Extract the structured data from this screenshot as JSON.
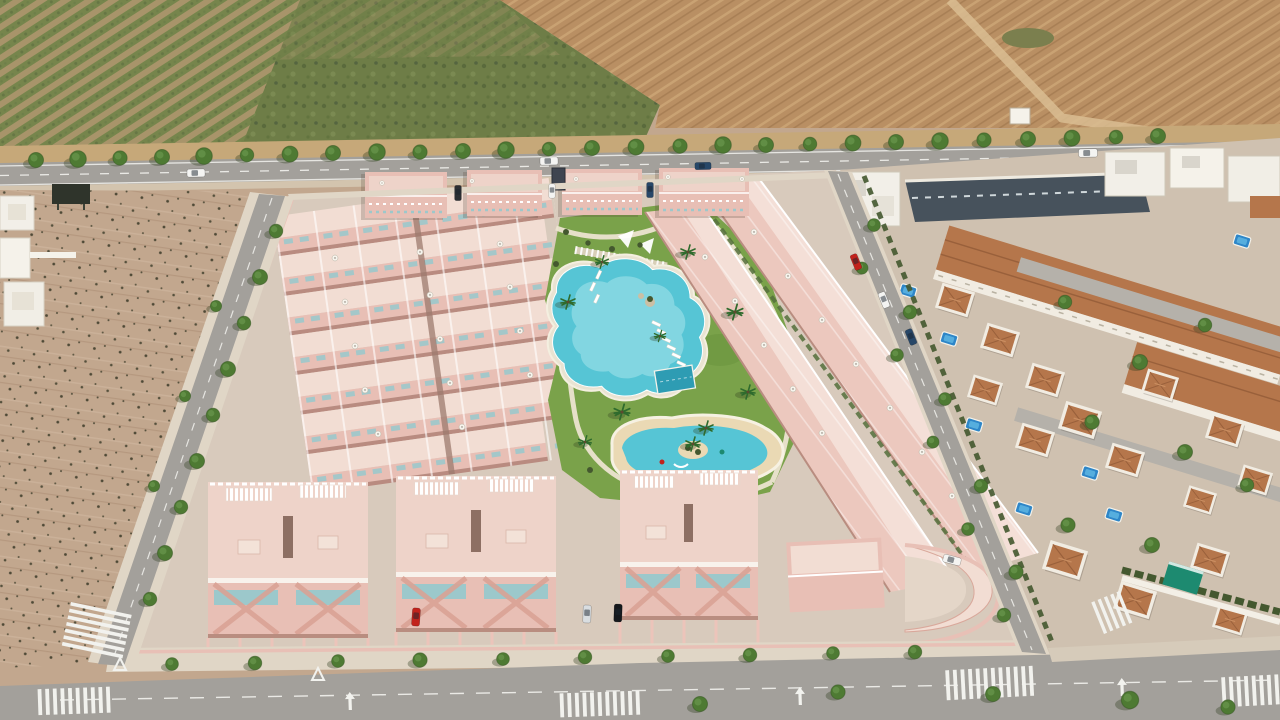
{
  "scene": {
    "kind": "aerial-3d-architectural-render",
    "setting": "new-build pink residential complex with communal pool gardens, bordered by an avenue, an empty plot, orchard and ploughed farmland, next to an existing Mediterranean villa neighbourhood"
  },
  "palette": {
    "orchard_soil": "#a8946a",
    "orchard_rows": "#76854c",
    "scrub_green": "#6e7d47",
    "field_tan": "#b98f63",
    "field_path": "#d9bd92",
    "verge_tan": "#c6a879",
    "road_asphalt": "#a3a09b",
    "marking_white": "#f2f2ee",
    "dirt_lot": "#c2a78e",
    "pavement": "#d8cabc",
    "sidewalk": "#e0d6c6",
    "pink_wall": "#e8bfb5",
    "pink_light": "#f4dfd7",
    "pink_roof": "#eed3c9",
    "pink_shadow": "#b98d80",
    "teal_glass": "#9cc8cb",
    "lawn": "#7aa24a",
    "lawn_dark": "#6a9440",
    "pool_water": "#56c5d5",
    "pool_shallow": "#aee8ee",
    "pool_dark": "#2e9cb3",
    "sand": "#ead9b4",
    "terracotta": "#b5764b",
    "terracotta_dark": "#99603b",
    "old_wall": "#f1ece2",
    "old_base": "#cfc1b0",
    "old_street": "#b5b1aa",
    "dark_row": "#47525c",
    "hedge": "#44582f",
    "awning_teal": "#1d8a70",
    "billboard_dark": "#2f342b",
    "car_red": "#c2221c",
    "car_silver": "#d9dde0",
    "car_black": "#15181c",
    "car_navy": "#274768",
    "van_white": "#f4f4f2"
  },
  "objects": {
    "road_trees": [
      {
        "x": 36,
        "y": 160,
        "s": 1
      },
      {
        "x": 78,
        "y": 159,
        "s": 1.1
      },
      {
        "x": 120,
        "y": 158,
        "s": 0.95
      },
      {
        "x": 162,
        "y": 157,
        "s": 1
      },
      {
        "x": 204,
        "y": 156,
        "s": 1.1
      },
      {
        "x": 247,
        "y": 155,
        "s": 0.9
      },
      {
        "x": 290,
        "y": 154,
        "s": 1.05
      },
      {
        "x": 333,
        "y": 153,
        "s": 1
      },
      {
        "x": 377,
        "y": 152,
        "s": 1.1
      },
      {
        "x": 420,
        "y": 152,
        "s": 0.95
      },
      {
        "x": 463,
        "y": 151,
        "s": 1
      },
      {
        "x": 506,
        "y": 150,
        "s": 1.1
      },
      {
        "x": 549,
        "y": 149,
        "s": 0.9
      },
      {
        "x": 592,
        "y": 148,
        "s": 1
      },
      {
        "x": 636,
        "y": 147,
        "s": 1.05
      },
      {
        "x": 680,
        "y": 146,
        "s": 0.95
      },
      {
        "x": 723,
        "y": 145,
        "s": 1.1
      },
      {
        "x": 766,
        "y": 145,
        "s": 1
      },
      {
        "x": 810,
        "y": 144,
        "s": 0.9
      },
      {
        "x": 853,
        "y": 143,
        "s": 1.05
      },
      {
        "x": 896,
        "y": 142,
        "s": 1
      },
      {
        "x": 940,
        "y": 141,
        "s": 1.1
      },
      {
        "x": 984,
        "y": 140,
        "s": 0.95
      },
      {
        "x": 1028,
        "y": 139,
        "s": 1
      },
      {
        "x": 1072,
        "y": 138,
        "s": 1.05
      },
      {
        "x": 1116,
        "y": 137,
        "s": 0.9
      },
      {
        "x": 1158,
        "y": 136,
        "s": 1
      }
    ],
    "left_street_trees": [
      {
        "x": 276,
        "y": 231,
        "s": 0.9
      },
      {
        "x": 260,
        "y": 277,
        "s": 1
      },
      {
        "x": 244,
        "y": 323,
        "s": 0.9
      },
      {
        "x": 228,
        "y": 369,
        "s": 1
      },
      {
        "x": 213,
        "y": 415,
        "s": 0.9
      },
      {
        "x": 197,
        "y": 461,
        "s": 1
      },
      {
        "x": 181,
        "y": 507,
        "s": 0.9
      },
      {
        "x": 165,
        "y": 553,
        "s": 1
      },
      {
        "x": 150,
        "y": 599,
        "s": 0.9
      },
      {
        "x": 216,
        "y": 306,
        "s": 0.75
      },
      {
        "x": 185,
        "y": 396,
        "s": 0.75
      },
      {
        "x": 154,
        "y": 486,
        "s": 0.75
      }
    ],
    "right_street_trees": [
      {
        "x": 874,
        "y": 225,
        "s": 0.85
      },
      {
        "x": 910,
        "y": 312,
        "s": 0.9
      },
      {
        "x": 945,
        "y": 399,
        "s": 0.85
      },
      {
        "x": 981,
        "y": 486,
        "s": 0.9
      },
      {
        "x": 1016,
        "y": 572,
        "s": 0.95
      },
      {
        "x": 862,
        "y": 268,
        "s": 0.8
      },
      {
        "x": 897,
        "y": 355,
        "s": 0.85
      },
      {
        "x": 933,
        "y": 442,
        "s": 0.8
      },
      {
        "x": 968,
        "y": 529,
        "s": 0.85
      },
      {
        "x": 1004,
        "y": 615,
        "s": 0.9
      }
    ],
    "bottom_sidewalk_trees": [
      {
        "x": 172,
        "y": 664,
        "s": 0.85
      },
      {
        "x": 255,
        "y": 663,
        "s": 0.9
      },
      {
        "x": 338,
        "y": 661,
        "s": 0.85
      },
      {
        "x": 420,
        "y": 660,
        "s": 0.95
      },
      {
        "x": 503,
        "y": 659,
        "s": 0.85
      },
      {
        "x": 585,
        "y": 657,
        "s": 0.9
      },
      {
        "x": 668,
        "y": 656,
        "s": 0.85
      },
      {
        "x": 750,
        "y": 655,
        "s": 0.9
      },
      {
        "x": 833,
        "y": 653,
        "s": 0.85
      },
      {
        "x": 915,
        "y": 652,
        "s": 0.9
      }
    ],
    "avenue_trees": [
      {
        "x": 700,
        "y": 704,
        "s": 1
      },
      {
        "x": 838,
        "y": 692,
        "s": 0.95
      },
      {
        "x": 993,
        "y": 694,
        "s": 1
      },
      {
        "x": 1130,
        "y": 700,
        "s": 1.15
      },
      {
        "x": 1228,
        "y": 707,
        "s": 0.95
      }
    ],
    "old_town_trees": [
      {
        "x": 1065,
        "y": 302,
        "s": 0.9
      },
      {
        "x": 1140,
        "y": 362,
        "s": 1
      },
      {
        "x": 1205,
        "y": 325,
        "s": 0.9
      },
      {
        "x": 1092,
        "y": 422,
        "s": 0.95
      },
      {
        "x": 1185,
        "y": 452,
        "s": 1
      },
      {
        "x": 1247,
        "y": 485,
        "s": 0.9
      },
      {
        "x": 1068,
        "y": 525,
        "s": 0.95
      },
      {
        "x": 1152,
        "y": 545,
        "s": 1
      }
    ],
    "park_palms": [
      {
        "x": 568,
        "y": 302,
        "s": 1
      },
      {
        "x": 602,
        "y": 262,
        "s": 0.9
      },
      {
        "x": 688,
        "y": 252,
        "s": 1
      },
      {
        "x": 735,
        "y": 312,
        "s": 1.1
      },
      {
        "x": 748,
        "y": 392,
        "s": 1
      },
      {
        "x": 622,
        "y": 412,
        "s": 1.1
      },
      {
        "x": 585,
        "y": 442,
        "s": 0.9
      },
      {
        "x": 706,
        "y": 428,
        "s": 1
      },
      {
        "x": 660,
        "y": 336,
        "s": 0.8
      }
    ],
    "park_bushes": [
      {
        "x": 566,
        "y": 232,
        "s": 1
      },
      {
        "x": 588,
        "y": 243,
        "s": 0.9
      },
      {
        "x": 612,
        "y": 249,
        "s": 1
      },
      {
        "x": 640,
        "y": 245,
        "s": 0.9
      },
      {
        "x": 666,
        "y": 237,
        "s": 1
      },
      {
        "x": 688,
        "y": 226,
        "s": 0.9
      },
      {
        "x": 556,
        "y": 264,
        "s": 1
      },
      {
        "x": 700,
        "y": 262,
        "s": 0.9
      },
      {
        "x": 722,
        "y": 284,
        "s": 1
      },
      {
        "x": 738,
        "y": 304,
        "s": 0.9
      },
      {
        "x": 748,
        "y": 330,
        "s": 1
      },
      {
        "x": 590,
        "y": 470,
        "s": 1
      }
    ],
    "private_pools": [
      {
        "x": 908,
        "y": 291,
        "r": 17
      },
      {
        "x": 949,
        "y": 339,
        "r": 17
      },
      {
        "x": 917,
        "y": 373,
        "r": 17
      },
      {
        "x": 974,
        "y": 425,
        "r": 17
      },
      {
        "x": 1090,
        "y": 473,
        "r": 17
      },
      {
        "x": 1114,
        "y": 515,
        "r": 17
      },
      {
        "x": 1024,
        "y": 509,
        "r": 17
      },
      {
        "x": 1242,
        "y": 241,
        "r": 17
      }
    ],
    "villas": [
      {
        "x": 955,
        "y": 300,
        "r": 17,
        "s": 1
      },
      {
        "x": 1000,
        "y": 340,
        "r": 17,
        "s": 1
      },
      {
        "x": 1045,
        "y": 380,
        "r": 17,
        "s": 1
      },
      {
        "x": 985,
        "y": 390,
        "r": 17,
        "s": 0.9
      },
      {
        "x": 1035,
        "y": 440,
        "r": 17,
        "s": 1
      },
      {
        "x": 1080,
        "y": 420,
        "r": 17,
        "s": 1.1
      },
      {
        "x": 1125,
        "y": 460,
        "r": 17,
        "s": 1
      },
      {
        "x": 1065,
        "y": 560,
        "r": 17,
        "s": 1.15
      },
      {
        "x": 1135,
        "y": 600,
        "r": 17,
        "s": 1.1
      },
      {
        "x": 1210,
        "y": 560,
        "r": 17,
        "s": 1
      },
      {
        "x": 1230,
        "y": 620,
        "r": 17,
        "s": 0.9
      },
      {
        "x": 1160,
        "y": 385,
        "r": 17,
        "s": 0.95
      },
      {
        "x": 1225,
        "y": 430,
        "r": 17,
        "s": 1
      },
      {
        "x": 1255,
        "y": 480,
        "r": 17,
        "s": 0.9
      },
      {
        "x": 1200,
        "y": 500,
        "r": 17,
        "s": 0.85
      },
      {
        "x": 975,
        "y": 585,
        "r": 17,
        "s": 1.05
      }
    ],
    "grid_umbrellas": [
      {
        "x": 335,
        "y": 258
      },
      {
        "x": 420,
        "y": 252
      },
      {
        "x": 500,
        "y": 244
      },
      {
        "x": 345,
        "y": 302
      },
      {
        "x": 430,
        "y": 295
      },
      {
        "x": 510,
        "y": 287
      },
      {
        "x": 355,
        "y": 346
      },
      {
        "x": 440,
        "y": 339
      },
      {
        "x": 520,
        "y": 331
      },
      {
        "x": 365,
        "y": 390
      },
      {
        "x": 450,
        "y": 383
      },
      {
        "x": 530,
        "y": 375
      },
      {
        "x": 378,
        "y": 434
      },
      {
        "x": 462,
        "y": 427
      }
    ],
    "terrace_umbrellas": [
      {
        "x": 754,
        "y": 232
      },
      {
        "x": 788,
        "y": 276
      },
      {
        "x": 822,
        "y": 320
      },
      {
        "x": 856,
        "y": 364
      },
      {
        "x": 890,
        "y": 408
      },
      {
        "x": 922,
        "y": 452
      },
      {
        "x": 952,
        "y": 496
      },
      {
        "x": 705,
        "y": 257
      },
      {
        "x": 735,
        "y": 301
      },
      {
        "x": 764,
        "y": 345
      },
      {
        "x": 793,
        "y": 389
      },
      {
        "x": 822,
        "y": 433
      }
    ],
    "roof_umbrellas": [
      {
        "x": 382,
        "y": 183,
        "s": 0.8
      },
      {
        "x": 472,
        "y": 181,
        "s": 0.8
      },
      {
        "x": 576,
        "y": 179,
        "s": 0.8
      },
      {
        "x": 668,
        "y": 177,
        "s": 0.8
      },
      {
        "x": 742,
        "y": 179,
        "s": 0.8
      }
    ],
    "road_vehicles": [
      {
        "x": 196,
        "y": 173,
        "r": -1,
        "fill": "#f4f4f2"
      },
      {
        "x": 549,
        "y": 161,
        "r": -1,
        "fill": "#f4f4f2"
      },
      {
        "x": 703,
        "y": 166,
        "r": -1,
        "fill": "#274768",
        "s": 0.9
      },
      {
        "x": 1088,
        "y": 153,
        "r": -1,
        "fill": "#f4f4f2",
        "s": 1.05
      }
    ],
    "parked_cars_top": [
      {
        "x": 458,
        "y": 193,
        "r": 90,
        "fill": "#2b2f33",
        "s": 0.85
      },
      {
        "x": 552,
        "y": 191,
        "r": 90,
        "fill": "#f4f4f2",
        "s": 0.8
      },
      {
        "x": 650,
        "y": 190,
        "r": 90,
        "fill": "#274768",
        "s": 0.85
      }
    ],
    "parked_cars_bottom": [
      {
        "x": 416,
        "y": 617,
        "r": 94,
        "fill": "#c2221c"
      },
      {
        "x": 587,
        "y": 614,
        "r": 92,
        "fill": "#d9dde0"
      },
      {
        "x": 618,
        "y": 613,
        "r": 92,
        "fill": "#15181c"
      },
      {
        "x": 952,
        "y": 560,
        "r": 15,
        "fill": "#f4f4f2"
      }
    ],
    "right_street_cars": [
      {
        "x": 856,
        "y": 262,
        "r": 68,
        "fill": "#c2221c",
        "s": 0.9
      },
      {
        "x": 884,
        "y": 300,
        "r": 68,
        "fill": "#f4f4f2",
        "s": 0.9
      },
      {
        "x": 911,
        "y": 337,
        "r": 68,
        "fill": "#274768",
        "s": 0.9
      }
    ]
  }
}
